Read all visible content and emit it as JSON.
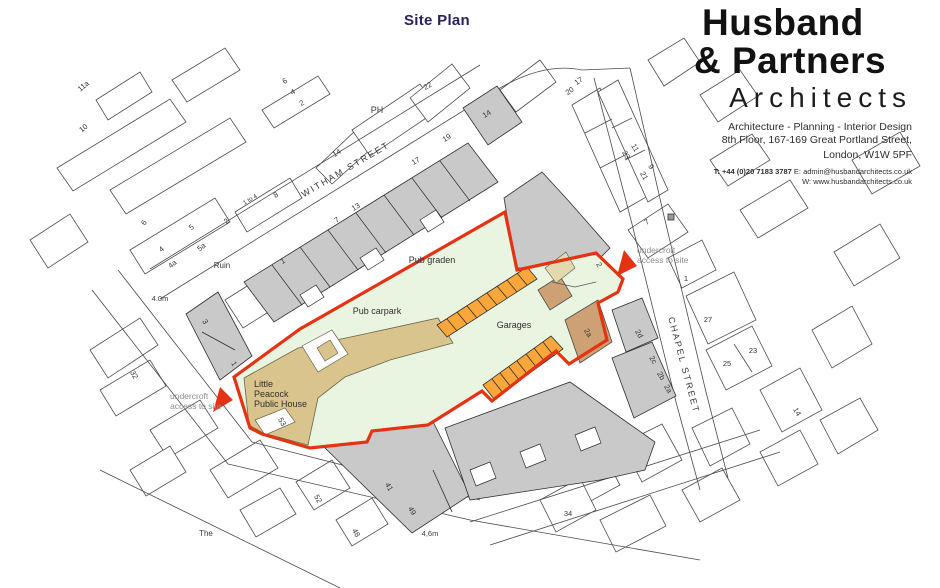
{
  "title": "Site Plan",
  "brand": {
    "name_line1": "Husband",
    "name_line2": "& Partners",
    "name_line3": "Architects",
    "tagline": "Architecture - Planning - Interior Design",
    "address_line1": "8th Floor, 167-169 Great Portland Street,",
    "address_line2": "London, W1W 5PF",
    "contact_phone": "T: +44 (0)20 7183 3787",
    "contact_email": " E: admin@husbandarchitects.co.uk",
    "contact_web": "W: www.husbandarchitects.co.uk"
  },
  "colors": {
    "title": "#2b2160",
    "site_boundary": "#e53212",
    "site_fill": "#e9f5e1",
    "pub_building": "#d9c48d",
    "garage_strip": "#f9a63b",
    "outbuilding": "#cda173",
    "building_gray": "#c9c9c9"
  },
  "map": {
    "labels": [
      {
        "id": "witham-street",
        "text": "WITHAM STREET",
        "x": 347,
        "y": 172,
        "r": -30.5,
        "s": 9,
        "ls": 2,
        "c": "#3a3a3a"
      },
      {
        "id": "chapel-street",
        "text": "CHAPEL STREET",
        "x": 681,
        "y": 366,
        "r": 75,
        "s": 9,
        "ls": 2,
        "c": "#3a3a3a"
      },
      {
        "id": "pub-garden",
        "text": "Pub graden",
        "x": 432,
        "y": 263,
        "r": 0,
        "s": 9,
        "c": "#2f2f2f"
      },
      {
        "id": "pub-carpark",
        "text": "Pub carpark",
        "x": 377,
        "y": 314,
        "r": 0,
        "s": 9,
        "c": "#2f2f2f"
      },
      {
        "id": "garages",
        "text": "Garages",
        "x": 514,
        "y": 328,
        "r": 0,
        "s": 9,
        "c": "#2f2f2f"
      },
      {
        "id": "pub-name-1",
        "text": "Little",
        "x": 254,
        "y": 387,
        "r": 0,
        "s": 9,
        "a": "start",
        "c": "#2f2f2f"
      },
      {
        "id": "pub-name-2",
        "text": "Peacock",
        "x": 254,
        "y": 397,
        "r": 0,
        "s": 9,
        "a": "start",
        "c": "#2f2f2f"
      },
      {
        "id": "pub-name-3",
        "text": "Public House",
        "x": 254,
        "y": 407,
        "r": 0,
        "s": 9,
        "a": "start",
        "c": "#2f2f2f"
      },
      {
        "id": "ruin",
        "text": "Ruin",
        "x": 222,
        "y": 268,
        "r": 0,
        "s": 8,
        "c": "#3a3a3a"
      },
      {
        "id": "ph",
        "text": "PH",
        "x": 377,
        "y": 113,
        "r": 0,
        "s": 9,
        "c": "#3a3a3a"
      },
      {
        "id": "the",
        "text": "The",
        "x": 206,
        "y": 536,
        "r": 0,
        "s": 8,
        "c": "#3a3a3a"
      },
      {
        "id": "access-left-1",
        "text": "undercroft",
        "x": 170,
        "y": 399,
        "r": 0,
        "s": 8.5,
        "a": "start",
        "c": "#8c8c8c"
      },
      {
        "id": "access-left-2",
        "text": "access to site",
        "x": 170,
        "y": 409,
        "r": 0,
        "s": 8.5,
        "a": "start",
        "c": "#8c8c8c"
      },
      {
        "id": "access-right-1",
        "text": "undercroft",
        "x": 637,
        "y": 253,
        "r": 0,
        "s": 8.5,
        "a": "start",
        "c": "#8c8c8c"
      },
      {
        "id": "access-right-2",
        "text": "access to site",
        "x": 637,
        "y": 263,
        "r": 0,
        "s": 8.5,
        "a": "start",
        "c": "#8c8c8c"
      },
      {
        "id": "dim-left",
        "text": "4.0m",
        "x": 160,
        "y": 301,
        "r": 0,
        "s": 7.5,
        "c": "#3a3a3a"
      },
      {
        "id": "dim-bottom",
        "text": "4,6m",
        "x": 430,
        "y": 536,
        "r": 0,
        "s": 7.5,
        "c": "#3a3a3a"
      },
      {
        "id": "n-11a",
        "text": "11a",
        "x": 85,
        "y": 88,
        "r": -40,
        "s": 7.5
      },
      {
        "id": "n-10",
        "text": "10",
        "x": 85,
        "y": 130,
        "r": -40,
        "s": 7.5
      },
      {
        "id": "n-6-left",
        "text": "6",
        "x": 146,
        "y": 224,
        "r": -55,
        "s": 7.5
      },
      {
        "id": "n-5",
        "text": "5",
        "x": 193,
        "y": 229,
        "r": -40,
        "s": 7.5
      },
      {
        "id": "n-4-left",
        "text": "4",
        "x": 163,
        "y": 251,
        "r": -40,
        "s": 7.5
      },
      {
        "id": "n-4a",
        "text": "4a",
        "x": 174,
        "y": 266,
        "r": -40,
        "s": 7.5
      },
      {
        "id": "n-5a",
        "text": "5a",
        "x": 203,
        "y": 249,
        "r": -40,
        "s": 7.5
      },
      {
        "id": "n-2-left",
        "text": "2",
        "x": 228,
        "y": 223,
        "r": -40,
        "s": 7.5
      },
      {
        "id": "n-1to4",
        "text": "1 to 4",
        "x": 251,
        "y": 201,
        "r": -31,
        "s": 6
      },
      {
        "id": "n-8",
        "text": "8",
        "x": 277,
        "y": 197,
        "r": -31,
        "s": 7.5
      },
      {
        "id": "n-6-top",
        "text": "6",
        "x": 286,
        "y": 83,
        "r": -31,
        "s": 7.5
      },
      {
        "id": "n-4-top",
        "text": "4",
        "x": 294,
        "y": 94,
        "r": -31,
        "s": 7.5
      },
      {
        "id": "n-2-top",
        "text": "2",
        "x": 303,
        "y": 105,
        "r": -31,
        "s": 7.5
      },
      {
        "id": "n-14-top",
        "text": "14",
        "x": 338,
        "y": 155,
        "r": -31,
        "s": 7.5
      },
      {
        "id": "n-22",
        "text": "22",
        "x": 429,
        "y": 88,
        "r": -31,
        "s": 7.5
      },
      {
        "id": "n-1-terrace",
        "text": "1",
        "x": 284,
        "y": 263,
        "r": -31,
        "s": 7.5
      },
      {
        "id": "n-7-terrace",
        "text": "7",
        "x": 338,
        "y": 222,
        "r": -31,
        "s": 7.5
      },
      {
        "id": "n-13",
        "text": "13",
        "x": 357,
        "y": 209,
        "r": -31,
        "s": 7.5
      },
      {
        "id": "n-17-terrace",
        "text": "17",
        "x": 417,
        "y": 163,
        "r": -31,
        "s": 7.5
      },
      {
        "id": "n-19",
        "text": "19",
        "x": 448,
        "y": 140,
        "r": -31,
        "s": 7.5
      },
      {
        "id": "n-14-terrace",
        "text": "14",
        "x": 488,
        "y": 116,
        "r": -31,
        "s": 7.5
      },
      {
        "id": "n-17-ne",
        "text": "17",
        "x": 580,
        "y": 83,
        "r": -35,
        "s": 7.5
      },
      {
        "id": "n-20",
        "text": "20",
        "x": 571,
        "y": 93,
        "r": -35,
        "s": 7.5
      },
      {
        "id": "n-11-ne",
        "text": "11",
        "x": 633,
        "y": 149,
        "r": 60,
        "s": 7.5
      },
      {
        "id": "n-23-ne",
        "text": "23",
        "x": 624,
        "y": 156,
        "r": 60,
        "s": 7.5
      },
      {
        "id": "n-9",
        "text": "9",
        "x": 649,
        "y": 168,
        "r": 60,
        "s": 7.5
      },
      {
        "id": "n-21",
        "text": "21",
        "x": 642,
        "y": 177,
        "r": 60,
        "s": 7.5
      },
      {
        "id": "n-7-ne",
        "text": "7",
        "x": 648,
        "y": 224,
        "r": -31,
        "s": 7.5
      },
      {
        "id": "n-1-chapel",
        "text": "1",
        "x": 686,
        "y": 281,
        "r": 0,
        "s": 7.5
      },
      {
        "id": "n-27",
        "text": "27",
        "x": 708,
        "y": 322,
        "r": 0,
        "s": 7.5
      },
      {
        "id": "n-25",
        "text": "25",
        "x": 727,
        "y": 366,
        "r": 0,
        "s": 7.5
      },
      {
        "id": "n-23-chapel",
        "text": "23",
        "x": 753,
        "y": 353,
        "r": 0,
        "s": 7.5
      },
      {
        "id": "n-14-chapel",
        "text": "14",
        "x": 795,
        "y": 413,
        "r": 60,
        "s": 7.5
      },
      {
        "id": "n-34",
        "text": "34",
        "x": 568,
        "y": 516,
        "r": 0,
        "s": 7.5
      },
      {
        "id": "n-2d",
        "text": "2d",
        "x": 637,
        "y": 335,
        "r": 60,
        "s": 7.5
      },
      {
        "id": "n-2c",
        "text": "2c",
        "x": 651,
        "y": 361,
        "r": 60,
        "s": 7.5
      },
      {
        "id": "n-2b",
        "text": "2b",
        "x": 659,
        "y": 377,
        "r": 60,
        "s": 7.5
      },
      {
        "id": "n-2a-row",
        "text": "2a",
        "x": 666,
        "y": 390,
        "r": 60,
        "s": 7.5
      },
      {
        "id": "n-2-site",
        "text": "2",
        "x": 597,
        "y": 266,
        "r": 60,
        "s": 7.5
      },
      {
        "id": "n-2a-site",
        "text": "2a",
        "x": 586,
        "y": 334,
        "r": 60,
        "s": 7.5
      },
      {
        "id": "n-53",
        "text": "53",
        "x": 280,
        "y": 423,
        "r": 60,
        "s": 7.5
      },
      {
        "id": "n-3",
        "text": "3",
        "x": 203,
        "y": 323,
        "r": 60,
        "s": 7.5
      },
      {
        "id": "n-1-gray",
        "text": "1",
        "x": 232,
        "y": 365,
        "r": 60,
        "s": 7.5
      },
      {
        "id": "n-32",
        "text": "32",
        "x": 132,
        "y": 376,
        "r": 60,
        "s": 7.5
      },
      {
        "id": "n-41",
        "text": "41",
        "x": 387,
        "y": 488,
        "r": 60,
        "s": 7.5
      },
      {
        "id": "n-49",
        "text": "49",
        "x": 410,
        "y": 512,
        "r": 60,
        "s": 7.5
      },
      {
        "id": "n-52",
        "text": "52",
        "x": 316,
        "y": 500,
        "r": 60,
        "s": 7.5
      },
      {
        "id": "n-48",
        "text": "48",
        "x": 354,
        "y": 534,
        "r": 60,
        "s": 7.5
      }
    ]
  }
}
